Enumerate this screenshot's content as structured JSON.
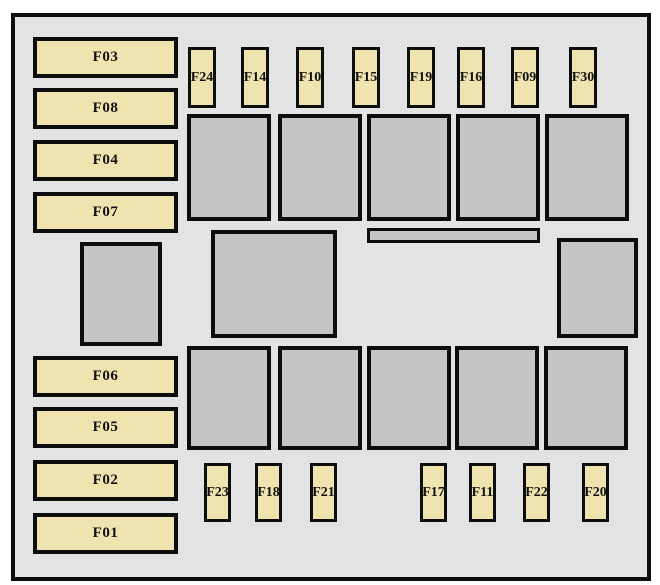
{
  "fusebox": {
    "left_fuses": [
      "F03",
      "F08",
      "F04",
      "F07",
      "F06",
      "F05",
      "F02",
      "F01"
    ],
    "top_fuses": [
      "F24",
      "F14",
      "F10",
      "F15",
      "F19",
      "F16",
      "F09",
      "F30"
    ],
    "bottom_fuses": [
      "F23",
      "F18",
      "F21",
      "F17",
      "F11",
      "F22",
      "F20"
    ],
    "relay_rows": {
      "top_count": 5,
      "bottom_count": 5
    },
    "misc_blocks": {
      "left_module": "",
      "center_module": "",
      "connector_bar": "",
      "right_module": ""
    }
  },
  "colors": {
    "page_bg": "#ffffff",
    "panel_fill": "#e3e3e3",
    "fuse_fill": "#efe3b0",
    "relay_fill": "#c5c5c5",
    "border": "#0d0d0d",
    "label_text": "#121212"
  }
}
